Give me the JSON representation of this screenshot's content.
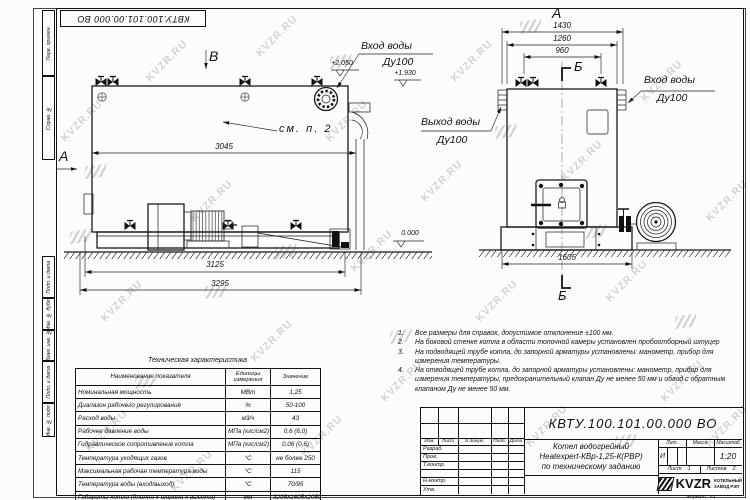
{
  "watermark": {
    "text": "KVZR.RU"
  },
  "frame": {
    "left_labels": [
      "Перв. примен.",
      "Справ. №",
      "Подп. и дата",
      "Инв. № дубл.",
      "Взам. инв. №",
      "Подп. и дата",
      "Инв. № подл."
    ],
    "format_label": "Формат",
    "format_value": "А3"
  },
  "views": {
    "side": {
      "view_label": "В",
      "section_label": "А",
      "see_note": "см. п. 2",
      "inlet_label": "Вход воды",
      "inlet_dn": "Ду100",
      "dim_3045": "3045",
      "dim_3125": "3125",
      "dim_3295": "3295",
      "level_top": "+2.050",
      "level_mid": "+1.930",
      "level_zero": "0.000"
    },
    "front": {
      "view_label": "А",
      "section_top": "Б",
      "section_bottom": "Б",
      "outlet_label": "Выход воды",
      "outlet_dn": "Ду100",
      "inlet_label": "Вход воды",
      "inlet_dn": "Ду100",
      "dim_1430": "1430",
      "dim_1260": "1260",
      "dim_960": "960",
      "dim_1605": "1605"
    }
  },
  "notes": {
    "items": [
      {
        "num": "1.",
        "text": "Все размеры для справок, допустимое отклонение ±100 мм."
      },
      {
        "num": "2.",
        "text": "На боковой стенке котла в области топочной камеры установлен пробоотборный штуцер"
      },
      {
        "num": "3.",
        "text": "На подводящей трубе котла, до запорной арматуры установлены: манометр, прибор для измерения температуры."
      },
      {
        "num": "4.",
        "text": "На отводящей трубе котла, до запорной арматуры установлены: манометр, прибор для измерения температуры, предохранительный клапан Ду не менее 50 мм и обвод с обратным клапаном Ду не менее 50 мм."
      }
    ]
  },
  "tech_table": {
    "title": "Техническая характеристика",
    "headers": [
      "Наименование показателя",
      "Единицы измерения",
      "Значение"
    ],
    "rows": [
      [
        "Номинальная мощность",
        "МВт",
        "1,25"
      ],
      [
        "Диапазон рабочего регулирования",
        "%",
        "50-100"
      ],
      [
        "Расход воды",
        "м3/ч",
        "43"
      ],
      [
        "Рабочее давление воды",
        "МПа (кгс/см2)",
        "0,6 (6,0)"
      ],
      [
        "Гидравлическое сопротивление котла",
        "МПа (кгс/см2)",
        "0,06 (0,6)"
      ],
      [
        "Температура уходящих газов",
        "°С",
        "не более 250"
      ],
      [
        "Максимальная рабочая температура воды",
        "°С",
        "115"
      ],
      [
        "Температура воды (вход/выход)",
        "°С",
        "70/95"
      ],
      [
        "Габариты котла (длинна х ширина х высота)",
        "мм",
        "3295х1605х2050"
      ]
    ]
  },
  "title_block": {
    "doc_number": "КВТУ.100.101.00.000  ВО",
    "header_cols": [
      "Изм.",
      "Лист",
      "N докум.",
      "Подп.",
      "Дата"
    ],
    "staff_rows": [
      "Разраб.",
      "Пров.",
      "Т.контр.",
      "",
      "Н.контр.",
      "Утв."
    ],
    "title_lines": [
      "Котел водогрейный",
      "Heatexpert-КВр-1,25-К(РВР)",
      "по техническому заданию"
    ],
    "lit_header": "Лит.",
    "mass_header": "Масса",
    "scale_header": "Масштаб",
    "lit_value": "И",
    "scale_value": "1:20",
    "sheet_label": "Лист",
    "sheet_value": "1",
    "sheets_label": "Листов",
    "sheets_value": "2",
    "logo_text": "KVZR",
    "company_line1": "КОТЕЛЬНЫЙ",
    "company_line2": "ЗАВОД РЭП"
  }
}
